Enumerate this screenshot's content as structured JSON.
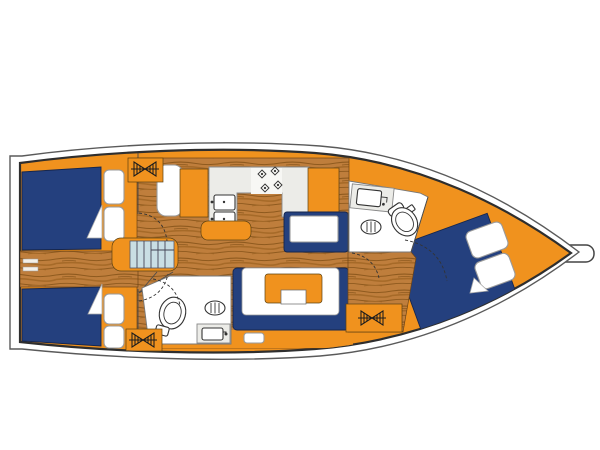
{
  "meta": {
    "title": "Sailing yacht interior layout plan, bow to the right",
    "diagram_type": "yacht-floor-plan"
  },
  "colors": {
    "hull_orange": "#F0921E",
    "berth_navy": "#24407E",
    "wood": "#BF7E3C",
    "wood_grain": "#8F5A1E",
    "stairs_blue": "#C9DEE4",
    "counter_grey": "#ECECE8",
    "outline_dark": "#2E2E2E",
    "background": "#FFFFFF"
  },
  "components": {
    "hull": {
      "orientation": "bow-right",
      "bowsprit": true
    },
    "cabins": [
      {
        "name": "aft-cabin-port",
        "features": [
          "double-berth",
          "pillows",
          "blanket-fold",
          "hanging-locker",
          "door"
        ]
      },
      {
        "name": "aft-cabin-starboard",
        "features": [
          "double-berth",
          "pillows",
          "blanket-fold",
          "door"
        ]
      },
      {
        "name": "forward-cabin",
        "features": [
          "double-berth-diagonal",
          "pillows",
          "blanket-fold",
          "hanging-locker",
          "door"
        ]
      }
    ],
    "heads": [
      {
        "name": "aft-head",
        "fixtures": [
          "toilet",
          "washbasin",
          "sink-counter",
          "door"
        ]
      },
      {
        "name": "forward-head",
        "fixtures": [
          "toilet",
          "washbasin",
          "sink-counter",
          "door"
        ]
      }
    ],
    "galley": {
      "fixtures": [
        "double-sink",
        "stove-4-burners",
        "l-shaped-counter",
        "cabinets",
        "island-unit"
      ]
    },
    "saloon": {
      "fixtures": [
        "u-shaped-settee",
        "saloon-table",
        "chaise-settee",
        "wood-floor"
      ]
    },
    "companionway": {
      "fixtures": [
        "stairs-5-treads",
        "landing"
      ]
    },
    "hanging_locker_symbol_count": 3
  }
}
